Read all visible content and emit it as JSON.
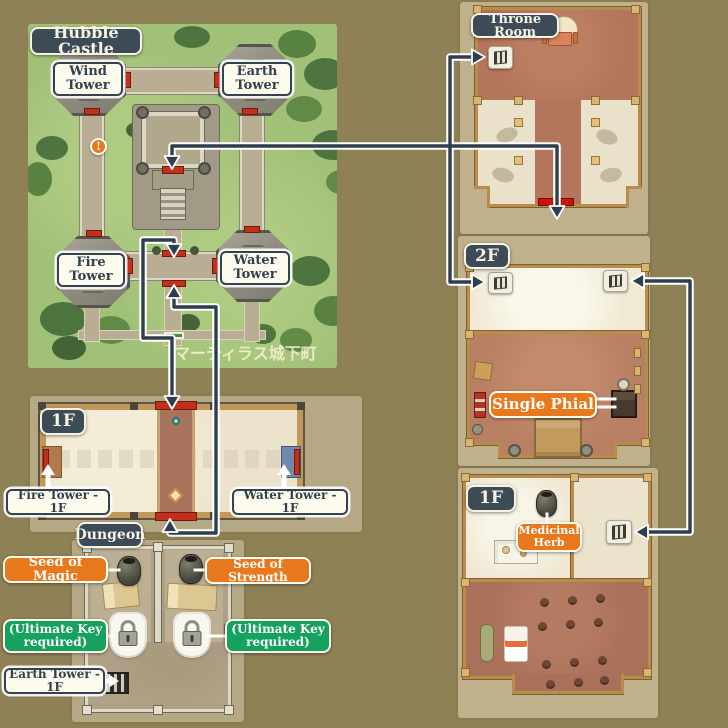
{
  "castle": {
    "title": "Hubble Castle",
    "towers": {
      "wind": {
        "line1": "Wind",
        "line2": "Tower"
      },
      "earth": {
        "line1": "Earth",
        "line2": "Tower"
      },
      "fire": {
        "line1": "Fire",
        "line2": "Tower"
      },
      "water": {
        "line1": "Water",
        "line2": "Tower"
      }
    },
    "alert_marker": "!",
    "town_caption": "マーティラス城下町"
  },
  "hall_1f": {
    "badge": "1F",
    "fire_exit_label": "Fire Tower - 1F",
    "water_exit_label": "Water Tower - 1F",
    "dungeon_badge": "Dungeon"
  },
  "dungeon": {
    "seed_left_label": "Seed of Magic",
    "seed_right_label": "Seed of Strength",
    "lock_left_label": {
      "line1": "(Ultimate Key",
      "line2": "required)"
    },
    "lock_right_label": {
      "line1": "(Ultimate Key",
      "line2": "required)"
    },
    "exit_label": "Earth Tower - 1F"
  },
  "throne_room": {
    "badge": "Throne Room"
  },
  "floor_2f": {
    "badge": "2F",
    "item_label": "Single Phial"
  },
  "floor_1f_right": {
    "badge": "1F",
    "item_label": {
      "line1": "Medicinal",
      "line2": "Herb"
    }
  },
  "colors": {
    "background": "#8e8155",
    "badge_dark": "#3d4b57",
    "label_orange": "#e8781c",
    "label_green": "#15a15e",
    "arrow_navy": "#2e3e4c",
    "door_red": "#c2301c",
    "grass_green": "#a2c178"
  }
}
